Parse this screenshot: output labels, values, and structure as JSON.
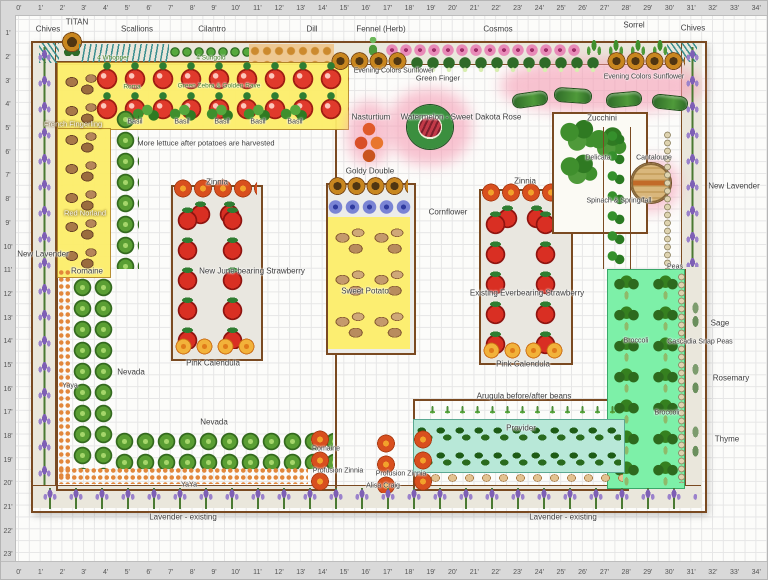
{
  "rulers": {
    "top": [
      "0'",
      "1'",
      "2'",
      "3'",
      "4'",
      "5'",
      "6'",
      "7'",
      "8'",
      "9'",
      "10'",
      "11'",
      "12'",
      "13'",
      "14'",
      "15'",
      "16'",
      "17'",
      "18'",
      "19'",
      "20'",
      "21'",
      "22'",
      "23'",
      "24'",
      "25'",
      "26'",
      "27'",
      "28'",
      "29'",
      "30'",
      "31'",
      "32'",
      "33'",
      "34'",
      "35'"
    ],
    "left": [
      "1'",
      "2'",
      "3'",
      "4'",
      "5'",
      "6'",
      "7'",
      "8'",
      "9'",
      "10'",
      "11'",
      "12'",
      "13'",
      "14'",
      "15'",
      "16'",
      "17'",
      "18'",
      "19'",
      "20'",
      "21'",
      "22'",
      "23'"
    ],
    "bottom": [
      "0'",
      "1'",
      "2'",
      "3'",
      "4'",
      "5'",
      "6'",
      "7'",
      "8'",
      "9'",
      "10'",
      "11'",
      "12'",
      "13'",
      "14'",
      "15'",
      "16'",
      "17'",
      "18'",
      "19'",
      "20'",
      "21'",
      "22'",
      "23'",
      "24'",
      "25'",
      "26'",
      "27'",
      "28'",
      "29'",
      "30'",
      "31'",
      "32'",
      "33'",
      "34'",
      "35'"
    ]
  },
  "labels": {
    "chives": "Chives",
    "titan": "TITAN",
    "scallions": "Scallions",
    "cilantro": "Cilantro",
    "dill": "Dill",
    "fennel_herb": "Fennel (Herb)",
    "cosmos": "Cosmos",
    "sorrel": "Sorrel",
    "tomato_count_1": "4 Whopper",
    "tomato_count_2": "4 Sungold",
    "tomato_var_1": "Roma",
    "tomato_var_2": "Green Zebra & Golden Rave",
    "basil": "Basil",
    "french_fingerling": "French Fingerling",
    "red_norland": "Red Norland",
    "more_lettuce": "More lettuce after potatoes are harvested",
    "nasturtium": "Nasturtium",
    "watermelon": "Watermelon - Sweet Dakota Rose",
    "evening_colors": "Evening Colors Sunflower",
    "green_finger": "Green Finger",
    "zucchini": "Zucchini",
    "delicata": "Delicata",
    "cantaloupe": "Cantaloupe",
    "spinach_note": "Spinach & Spring/fall",
    "new_lavender": "New Lavender",
    "romaine": "Romaine",
    "zinnia": "Zinnia",
    "goldy_double": "Goldy Double",
    "cornflower": "Cornflower",
    "june_strawberry": "New June-bearing Strawberry",
    "everbearing_strawberry": "Existing Everbearing Strawberry",
    "sweet_potato": "Sweet Potato",
    "pink_calendula": "Pink Calendula",
    "yaya": "Yaya",
    "yaya2": "YaYa",
    "nevada": "Nevada",
    "profusion_zinnia": "Profusion Zinnia",
    "alisa_craig": "Alisa Craig",
    "lavender_existing": "Lavender - existing",
    "arugula_note": "Arugula before/after beans",
    "provider": "Provider",
    "broccoli": "Broccoli",
    "cascadia_snap_peas": "Cascadia Snap Peas",
    "peas": "Peas",
    "sage": "Sage",
    "rosemary": "Rosemary",
    "thyme": "Thyme"
  },
  "colors": {
    "bed_border": "#7a4a21",
    "highlight_yellow": "#fdee6a",
    "highlight_pink": "#f59cb4",
    "bean_bed_green": "#b8e8d8",
    "broccoli_bed_green": "#7df0a8",
    "ruler_gray": "#d9d9d9"
  }
}
